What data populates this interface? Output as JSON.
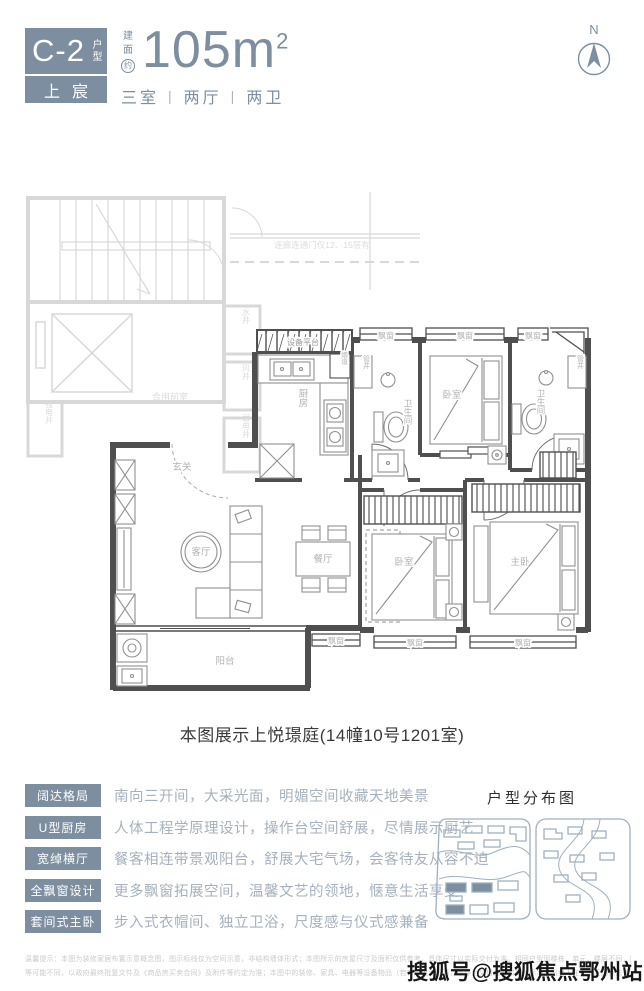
{
  "colors": {
    "accent": "#7C8EA0",
    "wall": "#4F4F4F",
    "common_gray": "#D8D8D8",
    "feature_text": "#A6B1BD"
  },
  "header": {
    "unit_code": "C-2",
    "unit_code_suffix": "户型",
    "project_name": "上宸",
    "area_prefix_char1": "建",
    "area_prefix_char2": "面",
    "area_prefix_char3": "约",
    "area_value": "105m",
    "area_sup": "2",
    "rooms_summary": [
      "三室",
      "两厅",
      "两卫"
    ],
    "separator": "|",
    "compass_label": "N"
  },
  "plan": {
    "caption": "本图展示上悦璟庭(14幢10号1201室)",
    "corridor_note": "连廊连通门仅12、15层有",
    "rooms": {
      "entry_hall": "玄关",
      "living": "客厅",
      "dining": "餐厅",
      "kitchen": "厨房",
      "balcony": "阳台",
      "bedroom_top": "卧室",
      "bedroom_bottom": "卧室",
      "master_bedroom": "主卧",
      "bathroom": "卫生间",
      "equipment_platform": "设备平台",
      "bay_window": "飘窗",
      "flue": "烟道",
      "pipe_shaft": "管井",
      "water_shaft": "水井",
      "air_shaft": "风井",
      "weak_current_shaft": "弱电井",
      "strong_current_shaft": "强电井",
      "shared_lobby": "合用前室"
    }
  },
  "features": [
    {
      "tag": "阔达格局",
      "desc": "南向三开间，大采光面，明媚空间收藏天地美景"
    },
    {
      "tag": "U型厨房",
      "desc": "人体工程学原理设计，操作台空间舒展，尽情展示厨艺"
    },
    {
      "tag": "宽绰横厅",
      "desc": "餐客相连带景观阳台，舒展大宅气场，会客待友从容不迫"
    },
    {
      "tag": "全飘窗设计",
      "desc": "更多飘窗拓展空间，温馨文艺的领地，惬意生活享受"
    },
    {
      "tag": "套间式主卧",
      "desc": "步入式衣帽间、独立卫浴，尺度感与仪式感兼备"
    }
  ],
  "distribution": {
    "title": "户型分布图"
  },
  "footer": {
    "disclaimer_line1": "温馨提示：本图为装修家居布置示意概念图，图示标线仅为空间示意，非结构墙体形式；本图所示的房屋尺寸及面积仅供参考，具体尺寸以实际交付为准。相同户型因楼栋、单元、楼层不同，阳台、飘窗、设备平台、外立面等",
    "disclaimer_line2": "等可能不同，以政府最终批复文件及《商品房买卖合同》及附件等约定为准；本图中的装修、家具、电器等设备物品（若有）仅为示意，不作为交付内容和交付标准。出卖人在不违反国家法律法规的前提下保留调整权利。",
    "watermark": "搜狐号@搜狐焦点鄂州站"
  }
}
